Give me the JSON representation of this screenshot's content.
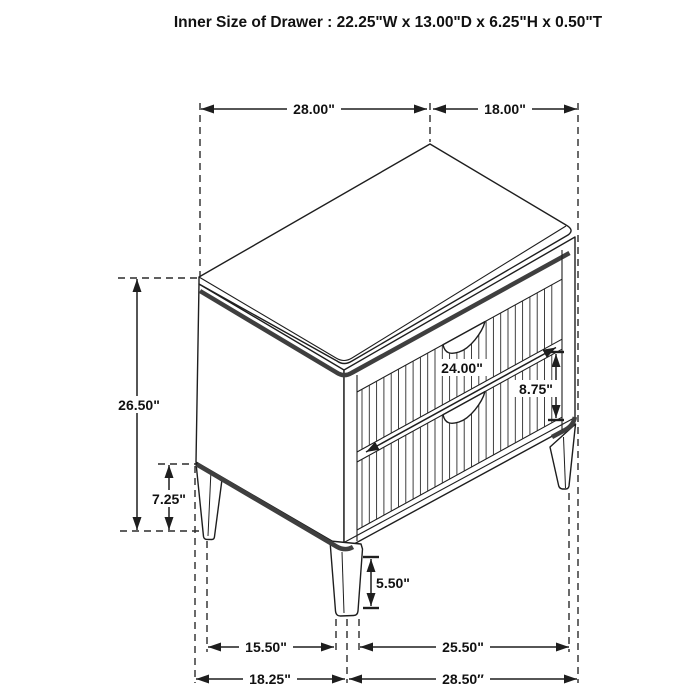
{
  "title": "Inner Size of Drawer : 22.25\"W x 13.00\"D x 6.25\"H x 0.50\"T",
  "dims": {
    "top_width": "28.00\"",
    "top_depth": "18.00\"",
    "overall_height": "26.50\"",
    "leg_section_height": "7.25\"",
    "drawer_width": "24.00\"",
    "drawer_front_height": "8.75\"",
    "front_leg_height": "5.50\"",
    "base_left_span": "15.50\"",
    "base_right_span": "25.50\"",
    "footprint_left": "18.25\"",
    "footprint_right": "28.50″"
  },
  "colors": {
    "line": "#1e1e1e",
    "accent_band": "#3f3f3f",
    "background": "#ffffff"
  }
}
